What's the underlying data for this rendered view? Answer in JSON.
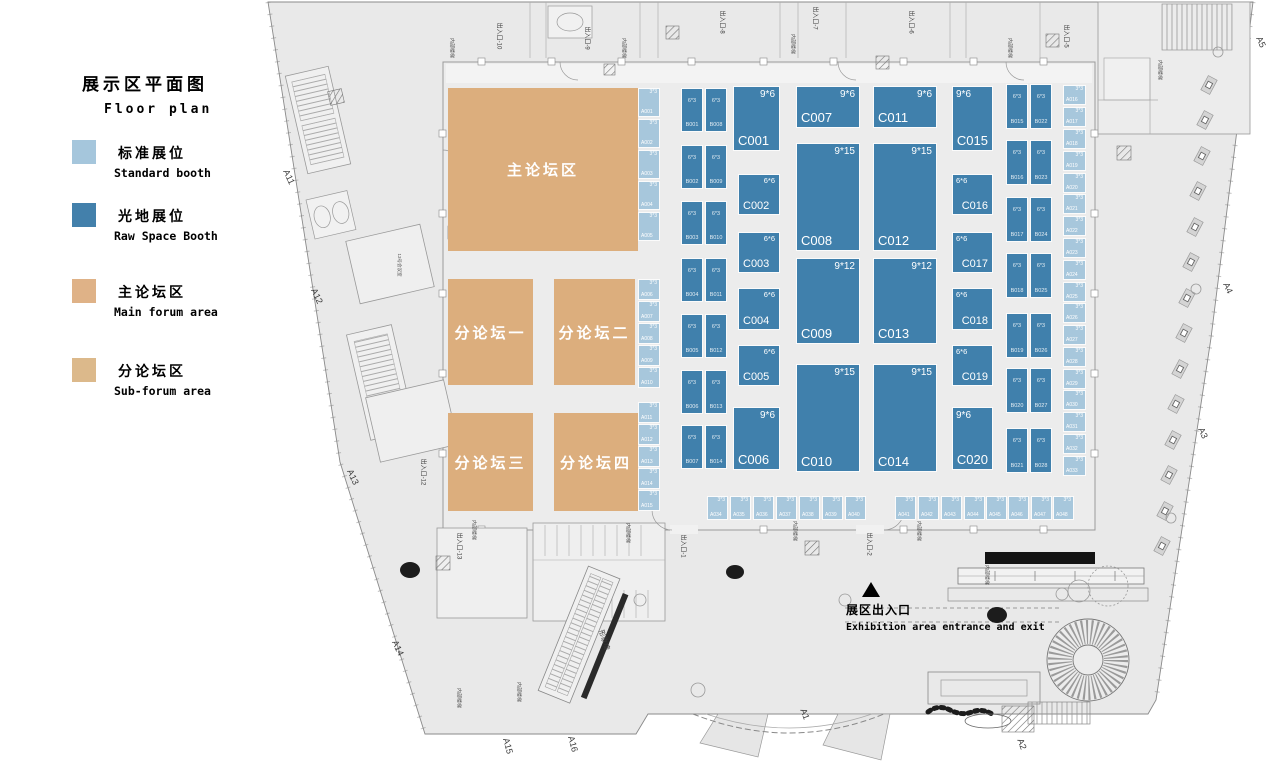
{
  "legend": {
    "title_zh": "展示区平面图",
    "title_en": "Floor plan",
    "items": [
      {
        "zh": "标准展位",
        "en": "Standard booth",
        "color": "#a5c6dc"
      },
      {
        "zh": "光地展位",
        "en": "Raw Space Booth",
        "color": "#4380ab"
      },
      {
        "zh": "主论坛区",
        "en": "Main forum area",
        "color": "#dfb287"
      },
      {
        "zh": "分论坛区",
        "en": "Sub-forum area",
        "color": "#dcb98b"
      }
    ]
  },
  "entrance": {
    "marker": "▲",
    "zh": "展区出入口",
    "en": "Exhibition area entrance and exit"
  },
  "forums": [
    {
      "label": "主论坛区",
      "x": 448,
      "y": 88,
      "w": 190,
      "h": 163
    },
    {
      "label": "分论坛一",
      "x": 448,
      "y": 279,
      "w": 85,
      "h": 106
    },
    {
      "label": "分论坛二",
      "x": 554,
      "y": 279,
      "w": 81,
      "h": 106
    },
    {
      "label": "分论坛三",
      "x": 448,
      "y": 413,
      "w": 85,
      "h": 98
    },
    {
      "label": "分论坛四",
      "x": 554,
      "y": 413,
      "w": 84,
      "h": 98
    }
  ],
  "booths": {
    "standard": [
      {
        "id": "A001",
        "dim": "3*3",
        "x": 638,
        "y": 88,
        "w": 22,
        "h": 29
      },
      {
        "id": "A002",
        "dim": "3*3",
        "x": 638,
        "y": 119,
        "w": 22,
        "h": 29
      },
      {
        "id": "A003",
        "dim": "3*3",
        "x": 638,
        "y": 150,
        "w": 22,
        "h": 29
      },
      {
        "id": "A004",
        "dim": "3*3",
        "x": 638,
        "y": 181,
        "w": 22,
        "h": 29
      },
      {
        "id": "A005",
        "dim": "3*3",
        "x": 638,
        "y": 212,
        "w": 22,
        "h": 29
      },
      {
        "id": "A006",
        "dim": "3*3",
        "x": 638,
        "y": 279,
        "w": 22,
        "h": 21
      },
      {
        "id": "A007",
        "dim": "3*3",
        "x": 638,
        "y": 301,
        "w": 22,
        "h": 21
      },
      {
        "id": "A008",
        "dim": "3*3",
        "x": 638,
        "y": 323,
        "w": 22,
        "h": 21
      },
      {
        "id": "A009",
        "dim": "3*3",
        "x": 638,
        "y": 345,
        "w": 22,
        "h": 21
      },
      {
        "id": "A010",
        "dim": "3*3",
        "x": 638,
        "y": 367,
        "w": 22,
        "h": 21
      },
      {
        "id": "A011",
        "dim": "3*3",
        "x": 638,
        "y": 402,
        "w": 22,
        "h": 21
      },
      {
        "id": "A012",
        "dim": "3*3",
        "x": 638,
        "y": 424,
        "w": 22,
        "h": 21
      },
      {
        "id": "A013",
        "dim": "3*3",
        "x": 638,
        "y": 446,
        "w": 22,
        "h": 21
      },
      {
        "id": "A014",
        "dim": "3*3",
        "x": 638,
        "y": 468,
        "w": 22,
        "h": 21
      },
      {
        "id": "A015",
        "dim": "3*3",
        "x": 638,
        "y": 490,
        "w": 22,
        "h": 21
      },
      {
        "id": "A016",
        "dim": "3*3",
        "x": 1063,
        "y": 85,
        "w": 23,
        "h": 20
      },
      {
        "id": "A017",
        "dim": "3*3",
        "x": 1063,
        "y": 107,
        "w": 23,
        "h": 20
      },
      {
        "id": "A018",
        "dim": "3*3",
        "x": 1063,
        "y": 129,
        "w": 23,
        "h": 20
      },
      {
        "id": "A019",
        "dim": "3*3",
        "x": 1063,
        "y": 151,
        "w": 23,
        "h": 20
      },
      {
        "id": "A020",
        "dim": "3*3",
        "x": 1063,
        "y": 173,
        "w": 23,
        "h": 20
      },
      {
        "id": "A021",
        "dim": "3*3",
        "x": 1063,
        "y": 194,
        "w": 23,
        "h": 20
      },
      {
        "id": "A022",
        "dim": "3*3",
        "x": 1063,
        "y": 216,
        "w": 23,
        "h": 20
      },
      {
        "id": "A023",
        "dim": "3*3",
        "x": 1063,
        "y": 238,
        "w": 23,
        "h": 20
      },
      {
        "id": "A024",
        "dim": "3*3",
        "x": 1063,
        "y": 260,
        "w": 23,
        "h": 20
      },
      {
        "id": "A025",
        "dim": "3*3",
        "x": 1063,
        "y": 282,
        "w": 23,
        "h": 20
      },
      {
        "id": "A026",
        "dim": "3*3",
        "x": 1063,
        "y": 303,
        "w": 23,
        "h": 20
      },
      {
        "id": "A027",
        "dim": "3*3",
        "x": 1063,
        "y": 325,
        "w": 23,
        "h": 20
      },
      {
        "id": "A028",
        "dim": "3*3",
        "x": 1063,
        "y": 347,
        "w": 23,
        "h": 20
      },
      {
        "id": "A029",
        "dim": "3*3",
        "x": 1063,
        "y": 369,
        "w": 23,
        "h": 20
      },
      {
        "id": "A030",
        "dim": "3*3",
        "x": 1063,
        "y": 390,
        "w": 23,
        "h": 20
      },
      {
        "id": "A031",
        "dim": "3*3",
        "x": 1063,
        "y": 412,
        "w": 23,
        "h": 20
      },
      {
        "id": "A032",
        "dim": "3*3",
        "x": 1063,
        "y": 434,
        "w": 23,
        "h": 20
      },
      {
        "id": "A033",
        "dim": "3*3",
        "x": 1063,
        "y": 456,
        "w": 23,
        "h": 20
      },
      {
        "id": "A034",
        "dim": "3*3",
        "x": 707,
        "y": 496,
        "w": 21,
        "h": 24
      },
      {
        "id": "A035",
        "dim": "3*3",
        "x": 730,
        "y": 496,
        "w": 21,
        "h": 24
      },
      {
        "id": "A036",
        "dim": "3*3",
        "x": 753,
        "y": 496,
        "w": 21,
        "h": 24
      },
      {
        "id": "A037",
        "dim": "3*3",
        "x": 776,
        "y": 496,
        "w": 21,
        "h": 24
      },
      {
        "id": "A038",
        "dim": "3*3",
        "x": 799,
        "y": 496,
        "w": 21,
        "h": 24
      },
      {
        "id": "A039",
        "dim": "3*3",
        "x": 822,
        "y": 496,
        "w": 21,
        "h": 24
      },
      {
        "id": "A040",
        "dim": "3*3",
        "x": 845,
        "y": 496,
        "w": 21,
        "h": 24
      },
      {
        "id": "A041",
        "dim": "3*3",
        "x": 895,
        "y": 496,
        "w": 21,
        "h": 24
      },
      {
        "id": "A042",
        "dim": "3*3",
        "x": 918,
        "y": 496,
        "w": 21,
        "h": 24
      },
      {
        "id": "A043",
        "dim": "3*3",
        "x": 941,
        "y": 496,
        "w": 21,
        "h": 24
      },
      {
        "id": "A044",
        "dim": "3*3",
        "x": 964,
        "y": 496,
        "w": 21,
        "h": 24
      },
      {
        "id": "A045",
        "dim": "3*3",
        "x": 986,
        "y": 496,
        "w": 21,
        "h": 24
      },
      {
        "id": "A046",
        "dim": "3*3",
        "x": 1008,
        "y": 496,
        "w": 21,
        "h": 24
      },
      {
        "id": "A047",
        "dim": "3*3",
        "x": 1031,
        "y": 496,
        "w": 21,
        "h": 24
      },
      {
        "id": "A048",
        "dim": "3*3",
        "x": 1053,
        "y": 496,
        "w": 21,
        "h": 24
      }
    ],
    "raw_b": [
      {
        "id": "B001",
        "dim": "6*3",
        "x": 681,
        "y": 88,
        "w": 22,
        "h": 44
      },
      {
        "id": "B002",
        "dim": "6*3",
        "x": 681,
        "y": 145,
        "w": 22,
        "h": 44
      },
      {
        "id": "B003",
        "dim": "6*3",
        "x": 681,
        "y": 201,
        "w": 22,
        "h": 44
      },
      {
        "id": "B004",
        "dim": "6*3",
        "x": 681,
        "y": 258,
        "w": 22,
        "h": 44
      },
      {
        "id": "B005",
        "dim": "6*3",
        "x": 681,
        "y": 314,
        "w": 22,
        "h": 44
      },
      {
        "id": "B006",
        "dim": "6*3",
        "x": 681,
        "y": 370,
        "w": 22,
        "h": 44
      },
      {
        "id": "B007",
        "dim": "6*3",
        "x": 681,
        "y": 425,
        "w": 22,
        "h": 44
      },
      {
        "id": "B008",
        "dim": "6*3",
        "x": 705,
        "y": 88,
        "w": 22,
        "h": 44
      },
      {
        "id": "B009",
        "dim": "6*3",
        "x": 705,
        "y": 145,
        "w": 22,
        "h": 44
      },
      {
        "id": "B010",
        "dim": "6*3",
        "x": 705,
        "y": 201,
        "w": 22,
        "h": 44
      },
      {
        "id": "B011",
        "dim": "6*3",
        "x": 705,
        "y": 258,
        "w": 22,
        "h": 44
      },
      {
        "id": "B012",
        "dim": "6*3",
        "x": 705,
        "y": 314,
        "w": 22,
        "h": 44
      },
      {
        "id": "B013",
        "dim": "6*3",
        "x": 705,
        "y": 370,
        "w": 22,
        "h": 44
      },
      {
        "id": "B014",
        "dim": "6*3",
        "x": 705,
        "y": 425,
        "w": 22,
        "h": 44
      },
      {
        "id": "B015",
        "dim": "6*3",
        "x": 1006,
        "y": 84,
        "w": 22,
        "h": 45
      },
      {
        "id": "B016",
        "dim": "6*3",
        "x": 1006,
        "y": 140,
        "w": 22,
        "h": 45
      },
      {
        "id": "B017",
        "dim": "6*3",
        "x": 1006,
        "y": 197,
        "w": 22,
        "h": 45
      },
      {
        "id": "B018",
        "dim": "6*3",
        "x": 1006,
        "y": 253,
        "w": 22,
        "h": 45
      },
      {
        "id": "B019",
        "dim": "6*3",
        "x": 1006,
        "y": 313,
        "w": 22,
        "h": 45
      },
      {
        "id": "B020",
        "dim": "6*3",
        "x": 1006,
        "y": 368,
        "w": 22,
        "h": 45
      },
      {
        "id": "B021",
        "dim": "6*3",
        "x": 1006,
        "y": 428,
        "w": 22,
        "h": 45
      },
      {
        "id": "B022",
        "dim": "6*3",
        "x": 1030,
        "y": 84,
        "w": 22,
        "h": 45
      },
      {
        "id": "B023",
        "dim": "6*3",
        "x": 1030,
        "y": 140,
        "w": 22,
        "h": 45
      },
      {
        "id": "B024",
        "dim": "6*3",
        "x": 1030,
        "y": 197,
        "w": 22,
        "h": 45
      },
      {
        "id": "B025",
        "dim": "6*3",
        "x": 1030,
        "y": 253,
        "w": 22,
        "h": 45
      },
      {
        "id": "B026",
        "dim": "6*3",
        "x": 1030,
        "y": 313,
        "w": 22,
        "h": 45
      },
      {
        "id": "B027",
        "dim": "6*3",
        "x": 1030,
        "y": 368,
        "w": 22,
        "h": 45
      },
      {
        "id": "B028",
        "dim": "6*3",
        "x": 1030,
        "y": 428,
        "w": 22,
        "h": 45
      }
    ],
    "raw_c": [
      {
        "id": "C001",
        "dim": "9*6",
        "x": 733,
        "y": 86,
        "w": 47,
        "h": 65,
        "a": "l"
      },
      {
        "id": "C002",
        "dim": "6*6",
        "x": 738,
        "y": 174,
        "w": 42,
        "h": 41,
        "a": "l"
      },
      {
        "id": "C003",
        "dim": "6*6",
        "x": 738,
        "y": 232,
        "w": 42,
        "h": 41,
        "a": "l"
      },
      {
        "id": "C004",
        "dim": "6*6",
        "x": 738,
        "y": 288,
        "w": 42,
        "h": 42,
        "a": "l"
      },
      {
        "id": "C005",
        "dim": "6*6",
        "x": 738,
        "y": 345,
        "w": 42,
        "h": 41,
        "a": "l"
      },
      {
        "id": "C006",
        "dim": "9*6",
        "x": 733,
        "y": 407,
        "w": 47,
        "h": 63,
        "a": "l"
      },
      {
        "id": "C007",
        "dim": "9*6",
        "x": 796,
        "y": 86,
        "w": 64,
        "h": 42,
        "a": "l"
      },
      {
        "id": "C008",
        "dim": "9*15",
        "x": 796,
        "y": 143,
        "w": 64,
        "h": 108,
        "a": "l"
      },
      {
        "id": "C009",
        "dim": "9*12",
        "x": 796,
        "y": 258,
        "w": 64,
        "h": 86,
        "a": "l"
      },
      {
        "id": "C010",
        "dim": "9*15",
        "x": 796,
        "y": 364,
        "w": 64,
        "h": 108,
        "a": "l"
      },
      {
        "id": "C011",
        "dim": "9*6",
        "x": 873,
        "y": 86,
        "w": 64,
        "h": 42,
        "a": "l"
      },
      {
        "id": "C012",
        "dim": "9*15",
        "x": 873,
        "y": 143,
        "w": 64,
        "h": 108,
        "a": "l"
      },
      {
        "id": "C013",
        "dim": "9*12",
        "x": 873,
        "y": 258,
        "w": 64,
        "h": 86,
        "a": "l"
      },
      {
        "id": "C014",
        "dim": "9*15",
        "x": 873,
        "y": 364,
        "w": 64,
        "h": 108,
        "a": "l"
      },
      {
        "id": "C015",
        "dim": "9*6",
        "x": 952,
        "y": 86,
        "w": 41,
        "h": 65,
        "a": "r"
      },
      {
        "id": "C016",
        "dim": "6*6",
        "x": 952,
        "y": 174,
        "w": 41,
        "h": 41,
        "a": "r"
      },
      {
        "id": "C017",
        "dim": "6*6",
        "x": 952,
        "y": 232,
        "w": 41,
        "h": 41,
        "a": "r"
      },
      {
        "id": "C018",
        "dim": "6*6",
        "x": 952,
        "y": 288,
        "w": 41,
        "h": 42,
        "a": "r"
      },
      {
        "id": "C019",
        "dim": "6*6",
        "x": 952,
        "y": 345,
        "w": 41,
        "h": 41,
        "a": "r"
      },
      {
        "id": "C020",
        "dim": "9*6",
        "x": 952,
        "y": 407,
        "w": 41,
        "h": 63,
        "a": "r"
      }
    ]
  },
  "plan_labels": [
    {
      "t": "出入口-10",
      "x": 500,
      "y": 36,
      "r": 90,
      "s": 6
    },
    {
      "t": "出入口-9",
      "x": 588,
      "y": 38,
      "r": 90,
      "s": 6
    },
    {
      "t": "出入口-8",
      "x": 723,
      "y": 22,
      "r": 90,
      "s": 6
    },
    {
      "t": "出入口-7",
      "x": 816,
      "y": 18,
      "r": 90,
      "s": 6
    },
    {
      "t": "出入口-6",
      "x": 912,
      "y": 22,
      "r": 90,
      "s": 6
    },
    {
      "t": "出入口-5",
      "x": 1067,
      "y": 36,
      "r": 90,
      "s": 6
    },
    {
      "t": "出入口-12",
      "x": 424,
      "y": 472,
      "r": 90,
      "s": 6
    },
    {
      "t": "出入口-13",
      "x": 460,
      "y": 546,
      "r": 90,
      "s": 6
    },
    {
      "t": "出入口-1",
      "x": 684,
      "y": 546,
      "r": 90,
      "s": 6
    },
    {
      "t": "出入口-2",
      "x": 870,
      "y": 544,
      "r": 90,
      "s": 6
    },
    {
      "t": "A11",
      "x": 289,
      "y": 177,
      "r": 65,
      "s": 9
    },
    {
      "t": "A12",
      "x": 317,
      "y": 296,
      "r": 65,
      "s": 9
    },
    {
      "t": "A13",
      "x": 353,
      "y": 477,
      "r": 65,
      "s": 9
    },
    {
      "t": "A14",
      "x": 398,
      "y": 648,
      "r": 65,
      "s": 9
    },
    {
      "t": "A15",
      "x": 508,
      "y": 746,
      "r": 75,
      "s": 9
    },
    {
      "t": "A16",
      "x": 573,
      "y": 744,
      "r": 75,
      "s": 9
    },
    {
      "t": "A1",
      "x": 805,
      "y": 714,
      "r": 70,
      "s": 9
    },
    {
      "t": "A2",
      "x": 1022,
      "y": 744,
      "r": 70,
      "s": 9
    },
    {
      "t": "A3",
      "x": 1203,
      "y": 433,
      "r": 65,
      "s": 9
    },
    {
      "t": "A4",
      "x": 1228,
      "y": 288,
      "r": 65,
      "s": 9
    },
    {
      "t": "A5",
      "x": 1261,
      "y": 42,
      "r": 65,
      "s": 9
    },
    {
      "t": "形象墙",
      "x": 604,
      "y": 640,
      "r": 72,
      "s": 7
    },
    {
      "t": "13号会议室",
      "x": 399,
      "y": 265,
      "r": 90,
      "s": 4.5
    },
    {
      "t": "内部楼梯",
      "x": 452,
      "y": 48,
      "r": 90,
      "s": 5
    },
    {
      "t": "内部楼梯",
      "x": 624,
      "y": 48,
      "r": 90,
      "s": 5
    },
    {
      "t": "内部楼梯",
      "x": 793,
      "y": 44,
      "r": 90,
      "s": 5
    },
    {
      "t": "内部楼梯",
      "x": 1010,
      "y": 48,
      "r": 90,
      "s": 5
    },
    {
      "t": "内部楼梯",
      "x": 1160,
      "y": 70,
      "r": 90,
      "s": 5
    },
    {
      "t": "内部楼梯",
      "x": 474,
      "y": 530,
      "r": 90,
      "s": 5
    },
    {
      "t": "内部楼梯",
      "x": 628,
      "y": 533,
      "r": 90,
      "s": 5
    },
    {
      "t": "内部楼梯",
      "x": 795,
      "y": 531,
      "r": 90,
      "s": 5
    },
    {
      "t": "内部楼梯",
      "x": 919,
      "y": 531,
      "r": 90,
      "s": 5
    },
    {
      "t": "内部楼梯",
      "x": 459,
      "y": 698,
      "r": 90,
      "s": 5
    },
    {
      "t": "内部楼梯",
      "x": 519,
      "y": 692,
      "r": 90,
      "s": 5
    },
    {
      "t": "内部楼梯",
      "x": 987,
      "y": 575,
      "r": 90,
      "s": 5
    }
  ]
}
